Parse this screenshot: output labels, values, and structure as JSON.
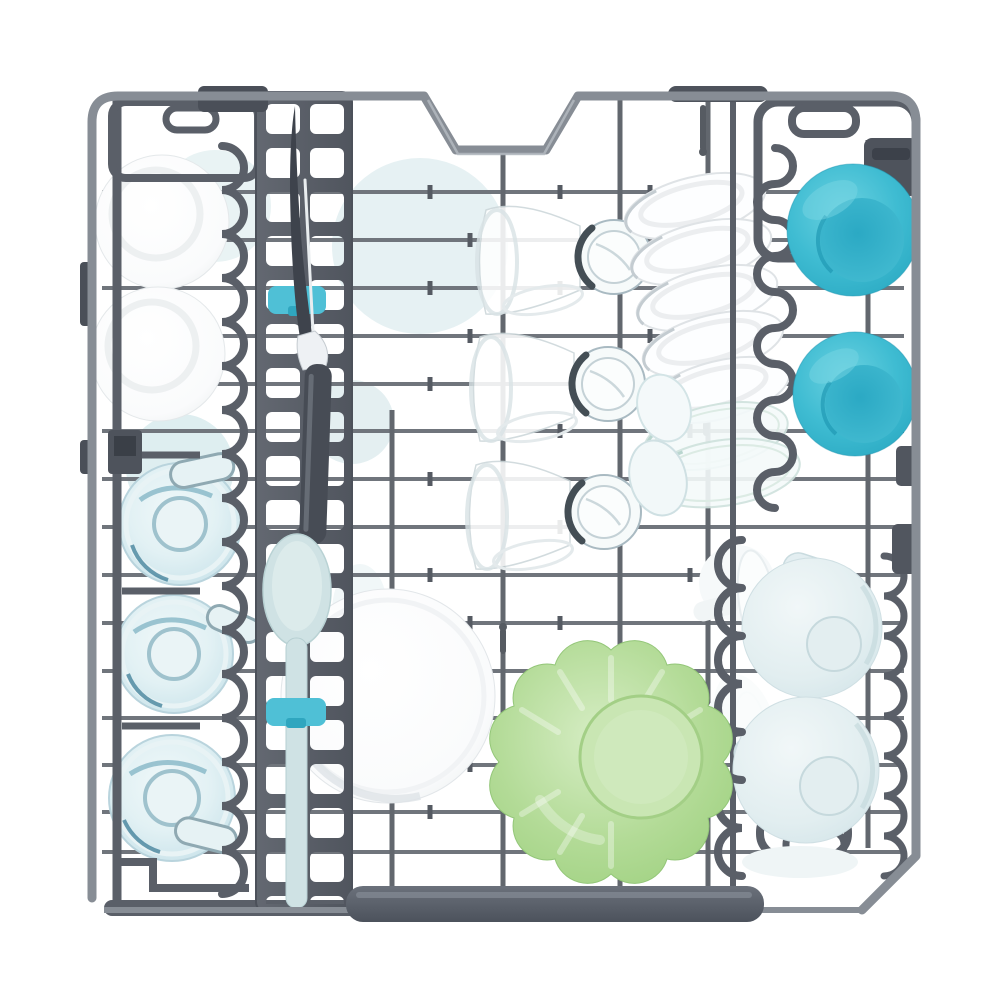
{
  "scene": {
    "type": "product-photo",
    "subject": "Top-down view of a dishwasher upper rack fully loaded with clean dishes",
    "view": "top-down",
    "background": "#ffffff"
  },
  "palette": {
    "white": "#ffffff",
    "whiteShade": "#e8eced",
    "wire": "#878d95",
    "wireThin": "#70757c",
    "wireDark": "#62676e",
    "plastic": "#5a5f68",
    "plasticDark": "#4a4f58",
    "ladderLight": "#636871",
    "ladderDark": "#50555e",
    "barLight": "#6b717b",
    "barDark": "#4c525c",
    "teal": "#3fbcd2",
    "tealLighter": "#6ad1e0",
    "tealDeep": "#2aa9c2",
    "tealInnerA": "#2ba9c4",
    "tealInnerB": "#47bed3",
    "green": "#b3db97",
    "greenLight": "#d6edc4",
    "greenDeep": "#9bcf7c",
    "cupLight": "#f1f7f8",
    "cupBlue": "#cfe2e7",
    "glassLight": "#f0f8f9",
    "glassBlue": "#bfdde6",
    "glassStreak": "#7fb3c3",
    "glassDark": "#2f7390",
    "clipTeal": "#4fc0d6",
    "clipDark": "#2fa6bf",
    "spoon": "#cfe2e4",
    "knife": "#3e434c",
    "paleBlue": "#e6f1f3"
  },
  "items": [
    {
      "name": "white-bowls-top-left",
      "count": 2,
      "color": "#ffffff"
    },
    {
      "name": "glass-mugs-left",
      "count": 3,
      "color": "#bfdde6"
    },
    {
      "name": "carving-knife-on-rail",
      "count": 1,
      "color": "#3e434c"
    },
    {
      "name": "serving-spoon-on-rail",
      "count": 1,
      "color": "#cfe2e4"
    },
    {
      "name": "teal-rail-clips",
      "count": 2,
      "color": "#4fc0d6"
    },
    {
      "name": "tumbler-glasses-center",
      "count": 3,
      "color": "#f0f8f9"
    },
    {
      "name": "large-white-bowl",
      "count": 1,
      "color": "#ffffff"
    },
    {
      "name": "green-fluted-bowl",
      "count": 1,
      "color": "#b3db97"
    },
    {
      "name": "white-plates-stack",
      "count": 5,
      "color": "#fdfeff"
    },
    {
      "name": "glass-plates",
      "count": 2,
      "color": "#f4fafa"
    },
    {
      "name": "teal-bowls-right",
      "count": 2,
      "color": "#3fbcd2"
    },
    {
      "name": "blue-cups-right",
      "count": 2,
      "color": "#cfe2e7"
    },
    {
      "name": "white-saucers-right",
      "count": 3,
      "color": "#fbfdfd"
    },
    {
      "name": "cutlery-ladder-rail",
      "count": 1,
      "color": "#50555e"
    },
    {
      "name": "rack-handle-bar",
      "count": 1,
      "color": "#4c525c"
    }
  ]
}
